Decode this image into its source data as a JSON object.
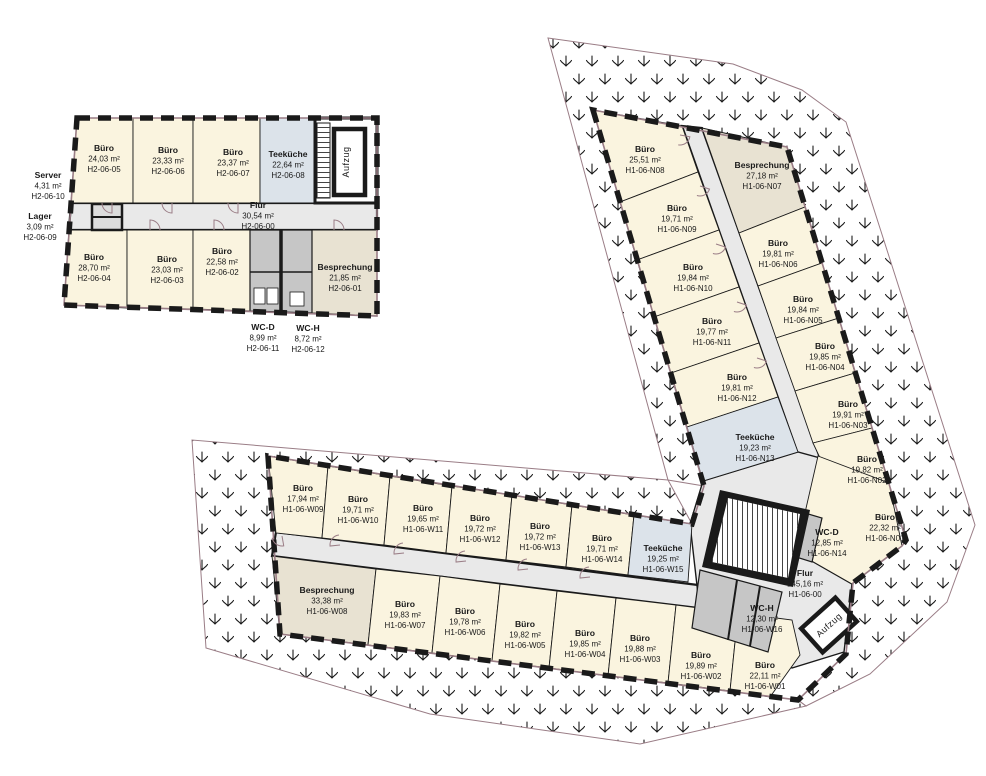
{
  "document_type": "floor-plan",
  "colors": {
    "buero": "#faf4df",
    "teekueche": "#dce3ea",
    "besprechung": "#e8e2d2",
    "wc": "#c6c6c6",
    "flur": "#e9e9e9",
    "wall": "#1a1a1a",
    "window": "#9a7d86",
    "hatch": "#1a1a1a"
  },
  "rooms": [
    {
      "code": "H2-06-05",
      "name": "Büro",
      "area": "24,03 m²",
      "type": "buero"
    },
    {
      "code": "H2-06-06",
      "name": "Büro",
      "area": "23,33 m²",
      "type": "buero"
    },
    {
      "code": "H2-06-07",
      "name": "Büro",
      "area": "23,37 m²",
      "type": "buero"
    },
    {
      "code": "H2-06-08",
      "name": "Teeküche",
      "area": "22,64 m²",
      "type": "teekueche"
    },
    {
      "code": "H2-06-00",
      "name": "Flur",
      "area": "30,54 m²",
      "type": "flur"
    },
    {
      "code": "H2-06-10",
      "name": "Server",
      "area": "4,31 m²",
      "type": "neben"
    },
    {
      "code": "H2-06-09",
      "name": "Lager",
      "area": "3,09 m²",
      "type": "neben"
    },
    {
      "code": "H2-06-04",
      "name": "Büro",
      "area": "28,70 m²",
      "type": "buero"
    },
    {
      "code": "H2-06-03",
      "name": "Büro",
      "area": "23,03 m²",
      "type": "buero"
    },
    {
      "code": "H2-06-02",
      "name": "Büro",
      "area": "22,58 m²",
      "type": "buero"
    },
    {
      "code": "H2-06-01",
      "name": "Besprechung",
      "area": "21,85 m²",
      "type": "besprechung"
    },
    {
      "code": "H2-06-11",
      "name": "WC-D",
      "area": "8,99 m²",
      "type": "wc"
    },
    {
      "code": "H2-06-12",
      "name": "WC-H",
      "area": "8,72 m²",
      "type": "wc"
    },
    {
      "code": "H1-06-N08",
      "name": "Büro",
      "area": "25,51 m²",
      "type": "buero"
    },
    {
      "code": "H1-06-N09",
      "name": "Büro",
      "area": "19,71 m²",
      "type": "buero"
    },
    {
      "code": "H1-06-N10",
      "name": "Büro",
      "area": "19,84 m²",
      "type": "buero"
    },
    {
      "code": "H1-06-N11",
      "name": "Büro",
      "area": "19,77 m²",
      "type": "buero"
    },
    {
      "code": "H1-06-N12",
      "name": "Büro",
      "area": "19,81 m²",
      "type": "buero"
    },
    {
      "code": "H1-06-N13",
      "name": "Teeküche",
      "area": "19,23 m²",
      "type": "teekueche"
    },
    {
      "code": "H1-06-N07",
      "name": "Besprechung",
      "area": "27,18 m²",
      "type": "besprechung"
    },
    {
      "code": "H1-06-N06",
      "name": "Büro",
      "area": "19,81 m²",
      "type": "buero"
    },
    {
      "code": "H1-06-N05",
      "name": "Büro",
      "area": "19,84 m²",
      "type": "buero"
    },
    {
      "code": "H1-06-N04",
      "name": "Büro",
      "area": "19,85 m²",
      "type": "buero"
    },
    {
      "code": "H1-06-N03",
      "name": "Büro",
      "area": "19,91 m²",
      "type": "buero"
    },
    {
      "code": "H1-06-N02",
      "name": "Büro",
      "area": "19,82 m²",
      "type": "buero"
    },
    {
      "code": "H1-06-N01",
      "name": "Büro",
      "area": "22,32 m²",
      "type": "buero"
    },
    {
      "code": "H1-06-N14",
      "name": "WC-D",
      "area": "12,85 m²",
      "type": "wc"
    },
    {
      "code": "H1-06-00",
      "name": "Flur",
      "area": "145,16 m²",
      "type": "flur"
    },
    {
      "code": "H1-06-W09",
      "name": "Büro",
      "area": "17,94 m²",
      "type": "buero"
    },
    {
      "code": "H1-06-W10",
      "name": "Büro",
      "area": "19,71 m²",
      "type": "buero"
    },
    {
      "code": "H1-06-W11",
      "name": "Büro",
      "area": "19,65 m²",
      "type": "buero"
    },
    {
      "code": "H1-06-W12",
      "name": "Büro",
      "area": "19,72 m²",
      "type": "buero"
    },
    {
      "code": "H1-06-W13",
      "name": "Büro",
      "area": "19,72 m²",
      "type": "buero"
    },
    {
      "code": "H1-06-W14",
      "name": "Büro",
      "area": "19,71 m²",
      "type": "buero"
    },
    {
      "code": "H1-06-W15",
      "name": "Teeküche",
      "area": "19,25 m²",
      "type": "teekueche"
    },
    {
      "code": "H1-06-W08",
      "name": "Besprechung",
      "area": "33,38 m²",
      "type": "besprechung"
    },
    {
      "code": "H1-06-W07",
      "name": "Büro",
      "area": "19,83 m²",
      "type": "buero"
    },
    {
      "code": "H1-06-W06",
      "name": "Büro",
      "area": "19,78 m²",
      "type": "buero"
    },
    {
      "code": "H1-06-W05",
      "name": "Büro",
      "area": "19,82 m²",
      "type": "buero"
    },
    {
      "code": "H1-06-W04",
      "name": "Büro",
      "area": "19,85 m²",
      "type": "buero"
    },
    {
      "code": "H1-06-W03",
      "name": "Büro",
      "area": "19,88 m²",
      "type": "buero"
    },
    {
      "code": "H1-06-W02",
      "name": "Büro",
      "area": "19,89 m²",
      "type": "buero"
    },
    {
      "code": "H1-06-W01",
      "name": "Büro",
      "area": "22,11 m²",
      "type": "buero"
    },
    {
      "code": "H1-06-W16",
      "name": "WC-H",
      "area": "12,30 m²",
      "type": "wc"
    }
  ],
  "elevators": [
    {
      "label": "Aufzug"
    },
    {
      "label": "Aufzug"
    }
  ]
}
